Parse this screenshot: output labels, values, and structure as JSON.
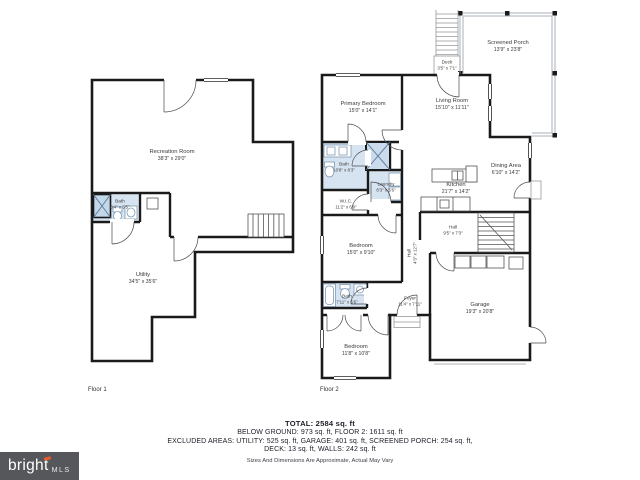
{
  "floor1": {
    "label": "Floor 1",
    "rooms": {
      "recreation": {
        "name": "Recreation Room",
        "dims": "38'3\" x 29'0\""
      },
      "bath": {
        "name": "Bath",
        "dims": "8'4\" x 5'5\""
      },
      "utility": {
        "name": "Utility",
        "dims": "34'5\" x 35'6\""
      }
    }
  },
  "floor2": {
    "label": "Floor 2",
    "rooms": {
      "screened_porch": {
        "name": "Screened Porch",
        "dims": "13'9\" x 23'8\""
      },
      "deck": {
        "name": "Deck",
        "dims": "3'5\" x 7'1\""
      },
      "primary_bedroom": {
        "name": "Primary Bedroom",
        "dims": "15'0\" x 14'1\""
      },
      "living_room": {
        "name": "Living Room",
        "dims": "15'10\" x 11'11\""
      },
      "bath_primary": {
        "name": "Bath",
        "dims": "10'8\" x 8'3\""
      },
      "laundry": {
        "name": "Laundry",
        "dims": "8'3\" x 5'6\""
      },
      "wic": {
        "name": "W.I.C.",
        "dims": "11'2\" x 6'9\""
      },
      "kitchen": {
        "name": "Kitchen",
        "dims": "21'7\" x 14'2\""
      },
      "dining_area": {
        "name": "Dining Area",
        "dims": "6'10\" x 14'2\""
      },
      "hall_upper": {
        "name": "Hall",
        "dims": "4'3\" x 12'7\""
      },
      "hall_lower": {
        "name": "Hall",
        "dims": "9'5\" x 7'3\""
      },
      "bedroom_mid": {
        "name": "Bedroom",
        "dims": "15'0\" x 9'10\""
      },
      "bath_hall": {
        "name": "Bath",
        "dims": "7'11\" x 5'6\""
      },
      "foyer": {
        "name": "Foyer",
        "dims": "11'4\" x 7'11\""
      },
      "bedroom_front": {
        "name": "Bedroom",
        "dims": "11'8\" x 10'8\""
      },
      "garage": {
        "name": "Garage",
        "dims": "19'3\" x 20'8\""
      }
    }
  },
  "summary": {
    "total": "TOTAL: 2584 sq. ft",
    "line1": "BELOW GROUND: 973 sq. ft, FLOOR 2: 1611 sq. ft",
    "line2": "EXCLUDED AREAS: UTILITY: 525 sq. ft, GARAGE: 401 sq. ft, SCREENED PORCH: 254 sq. ft,",
    "line3": "DECK: 13 sq. ft, WALLS: 242 sq. ft",
    "disclaimer": "Sizes And Dimensions Are Approximate, Actual May Vary"
  },
  "logo": {
    "brand": "bright",
    "suffix": "MLS",
    "bg": "#55575B",
    "accent": "#F05A28"
  },
  "colors": {
    "wall": "#1A1A1A",
    "wet_fill": "#D6E4F2",
    "porch_line": "#AAB1B8",
    "label_text": "#3A3A3A"
  }
}
